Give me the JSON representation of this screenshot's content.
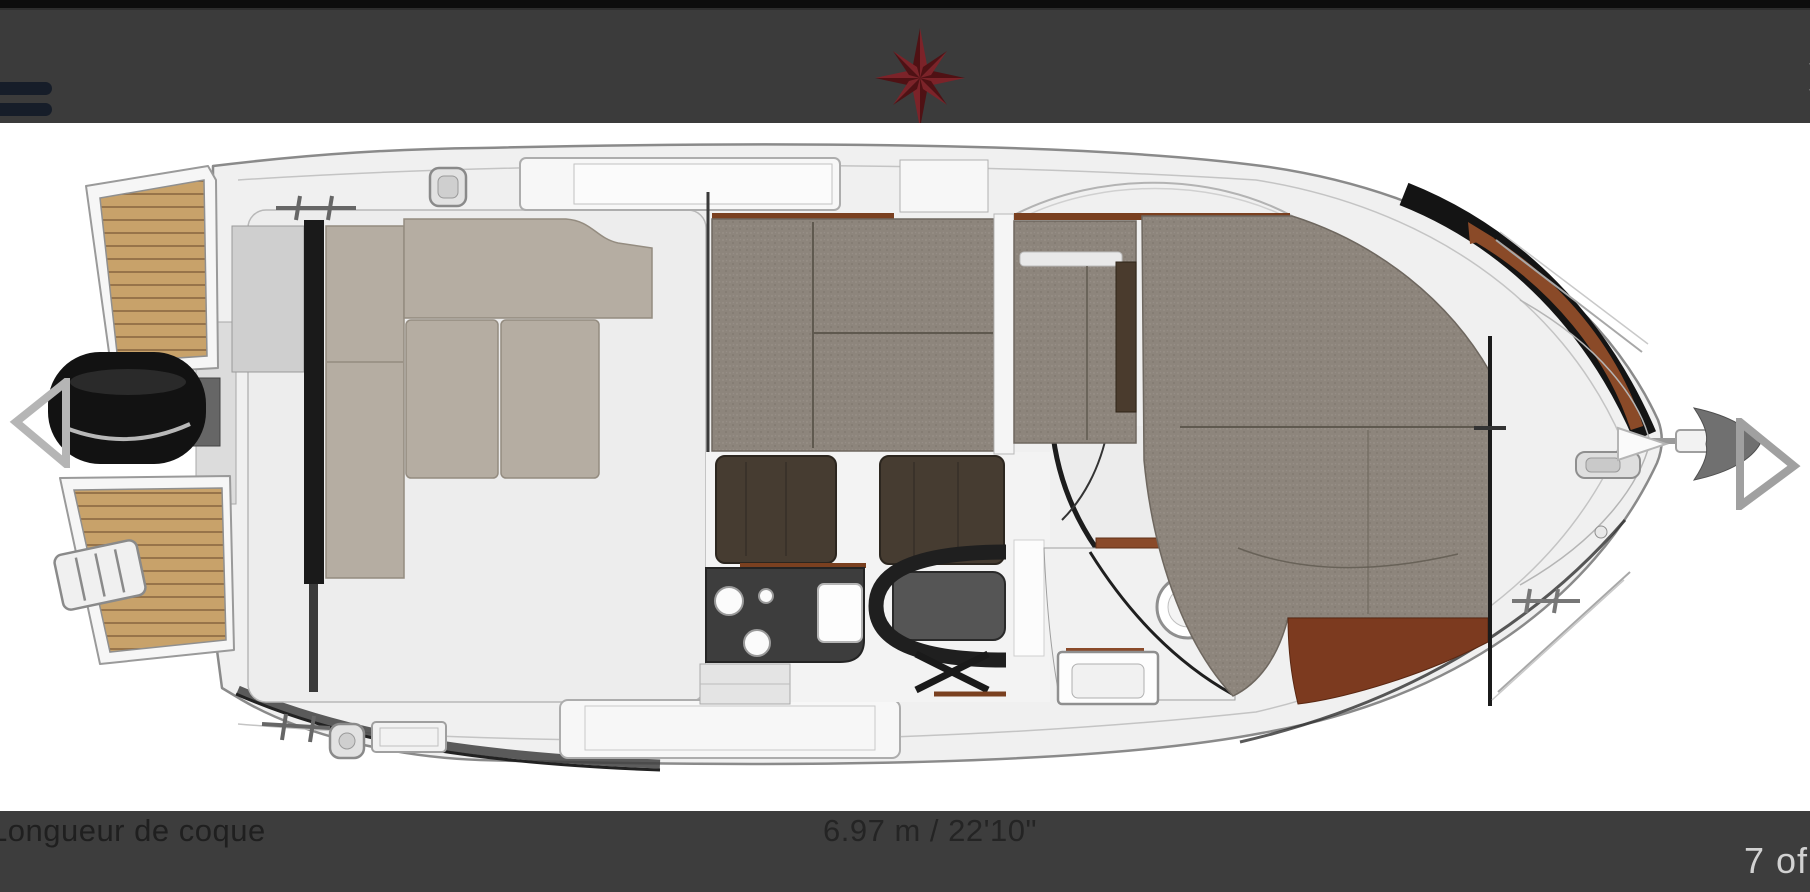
{
  "header": {
    "menu_icon": "hamburger",
    "logo_icon": "compass-rose",
    "close_label": "✕"
  },
  "viewer": {
    "image_name": "boat-deck-plan-top-view",
    "prev_icon": "chevron-left",
    "next_icon": "chevron-right"
  },
  "footer": {
    "spec_label": "Longueur de coque",
    "spec_value": "6.97 m / 22'10\"",
    "counter": "7 of"
  },
  "colors": {
    "top_strip": "#0d0d0d",
    "header_bar": "#3b3b3b",
    "logo_red": "#6f2127",
    "footer_bar": "#3d3d3d",
    "footer_text": "#1f1f1f",
    "counter_text": "#d2d2d2",
    "teak": "#c8a26a",
    "carpet": "#8d857c",
    "upholstery": "#b5ada2",
    "dark_wood": "#463c31",
    "mahogany": "#7c3a1f",
    "trim_brown": "#8a4a28",
    "motor_black": "#141414"
  }
}
